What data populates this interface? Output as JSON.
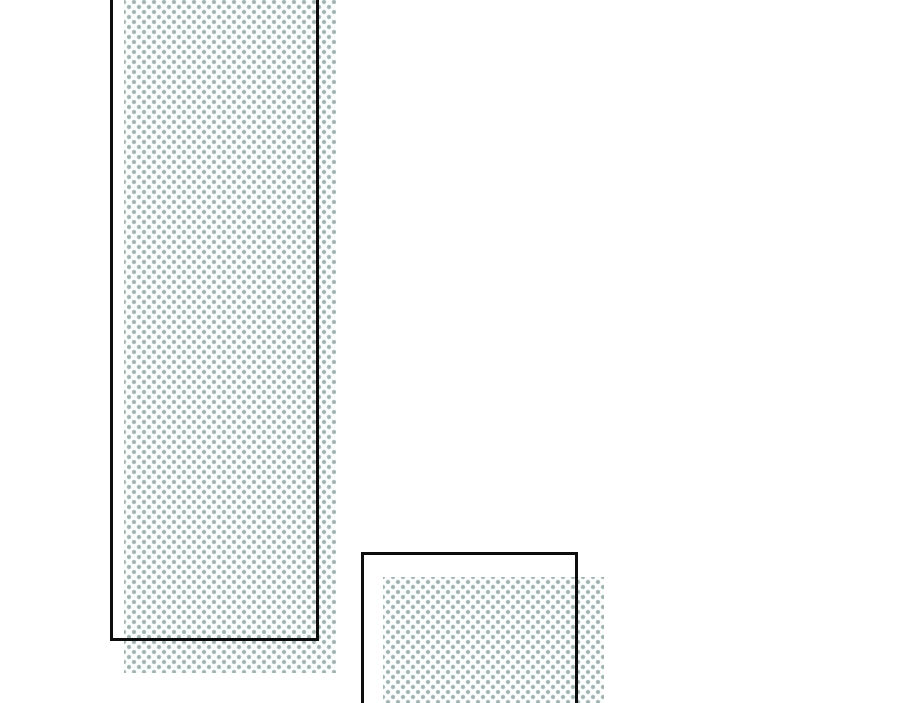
{
  "page": {
    "kind": "comic-page-panels",
    "visible_text": ""
  },
  "colors": {
    "page-bg": "#ffffff",
    "outline-color": "#0d0d0d",
    "dot-color": "#9fb2b0",
    "dot-halo": "rgba(159,178,176,0.55)",
    "halftone-bg": "#fbfdfd"
  },
  "panels": [
    {
      "id": "panel-1",
      "position": "tall-left",
      "cropped_edge": "top"
    },
    {
      "id": "panel-2",
      "position": "bottom-center",
      "cropped_edge": "bottom"
    }
  ]
}
